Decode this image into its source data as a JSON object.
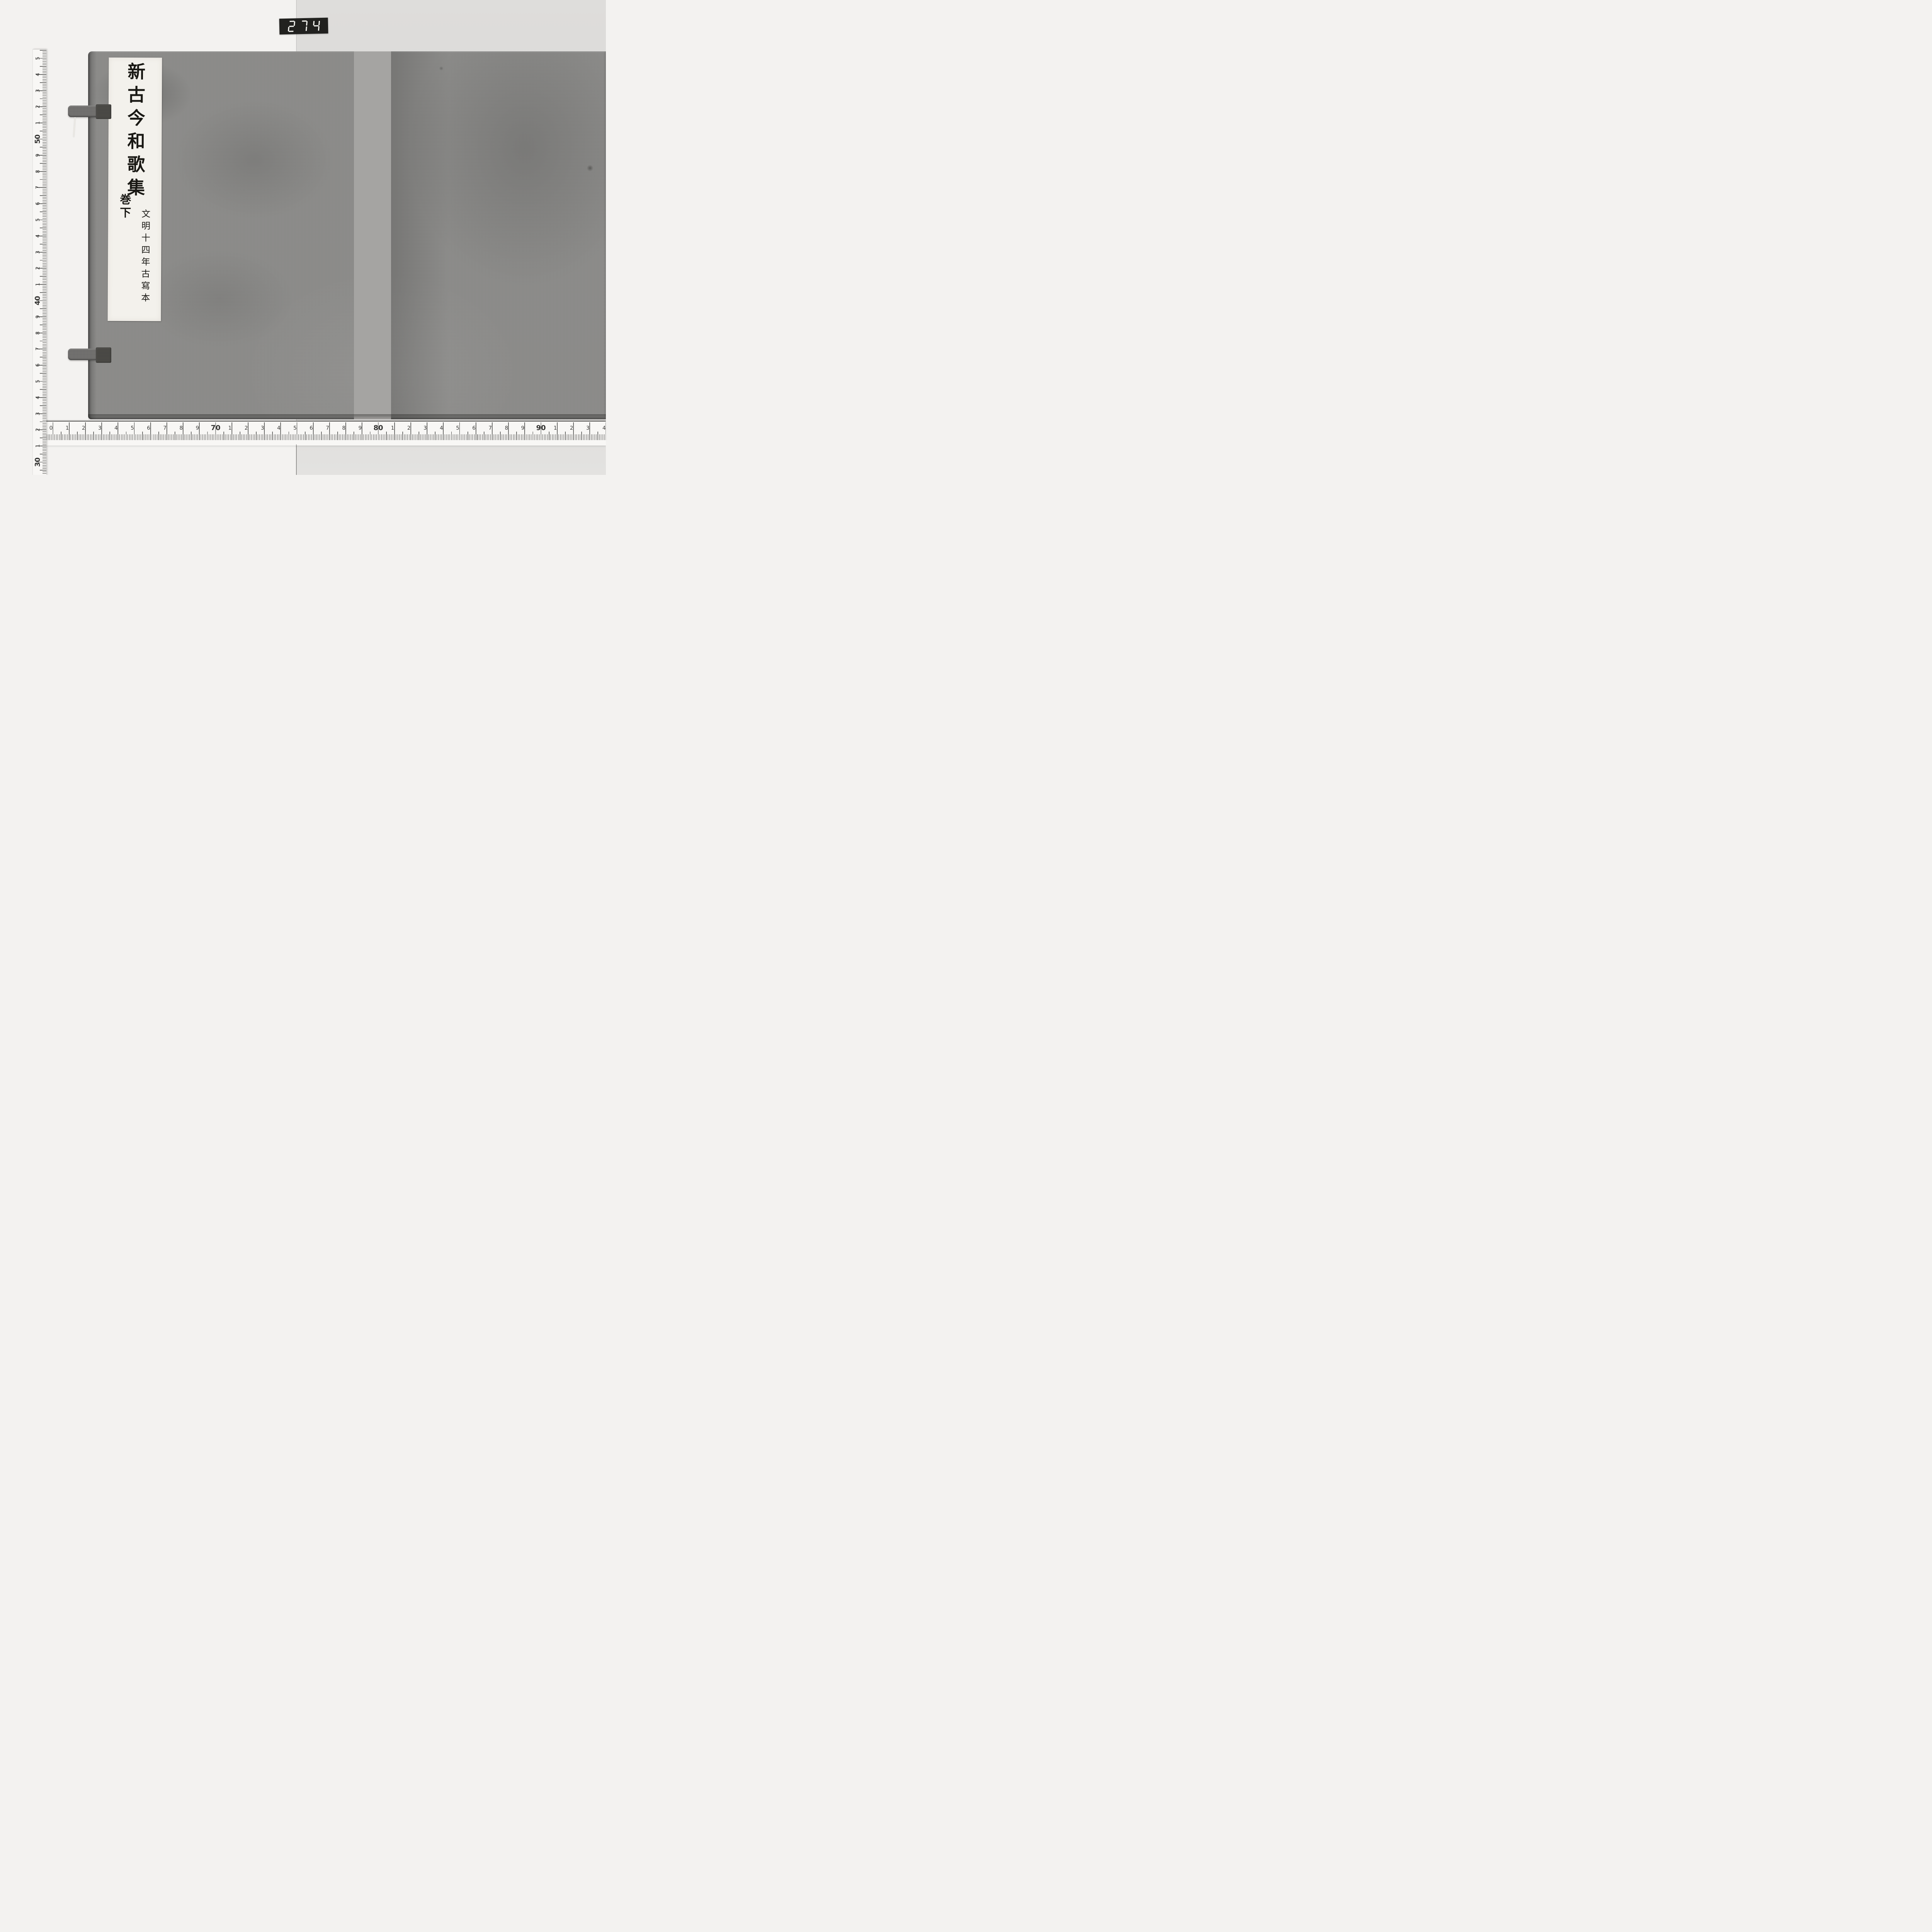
{
  "photo": {
    "plate": {
      "number": "274",
      "digits": [
        "2",
        "7",
        "4"
      ],
      "bg_color": "#21211f",
      "digit_color": "#f8f8f4"
    },
    "book": {
      "cover_color": "#8d8c8a",
      "spine_color": "#a5a4a2",
      "label": {
        "bg_color": "#f3f1ec",
        "main_title": "新古今和歌集",
        "volume": "巻下",
        "note": "文明十四年古寫本"
      }
    },
    "rulers": {
      "unit": "cm",
      "vertical": {
        "orientation": "top-to-bottom, values decreasing",
        "labels": [
          "5",
          "4",
          "3",
          "2",
          "1",
          "50",
          "9",
          "8",
          "7",
          "6",
          "5",
          "4",
          "3",
          "2",
          "1",
          "40",
          "9",
          "8",
          "7",
          "6",
          "5",
          "4",
          "3",
          "2",
          "1",
          "30",
          "9"
        ]
      },
      "horizontal": {
        "orientation": "left-to-right, values increasing",
        "labels": [
          "0",
          "1",
          "2",
          "3",
          "4",
          "5",
          "6",
          "7",
          "8",
          "9",
          "70",
          "1",
          "2",
          "3",
          "4",
          "5",
          "6",
          "7",
          "8",
          "9",
          "80",
          "1",
          "2",
          "3",
          "4",
          "5",
          "6",
          "7",
          "8",
          "9",
          "90",
          "1",
          "2",
          "3",
          "4"
        ]
      }
    },
    "background": {
      "left_color": "#f3f2f0",
      "right_color": "#d9d8d6"
    }
  }
}
